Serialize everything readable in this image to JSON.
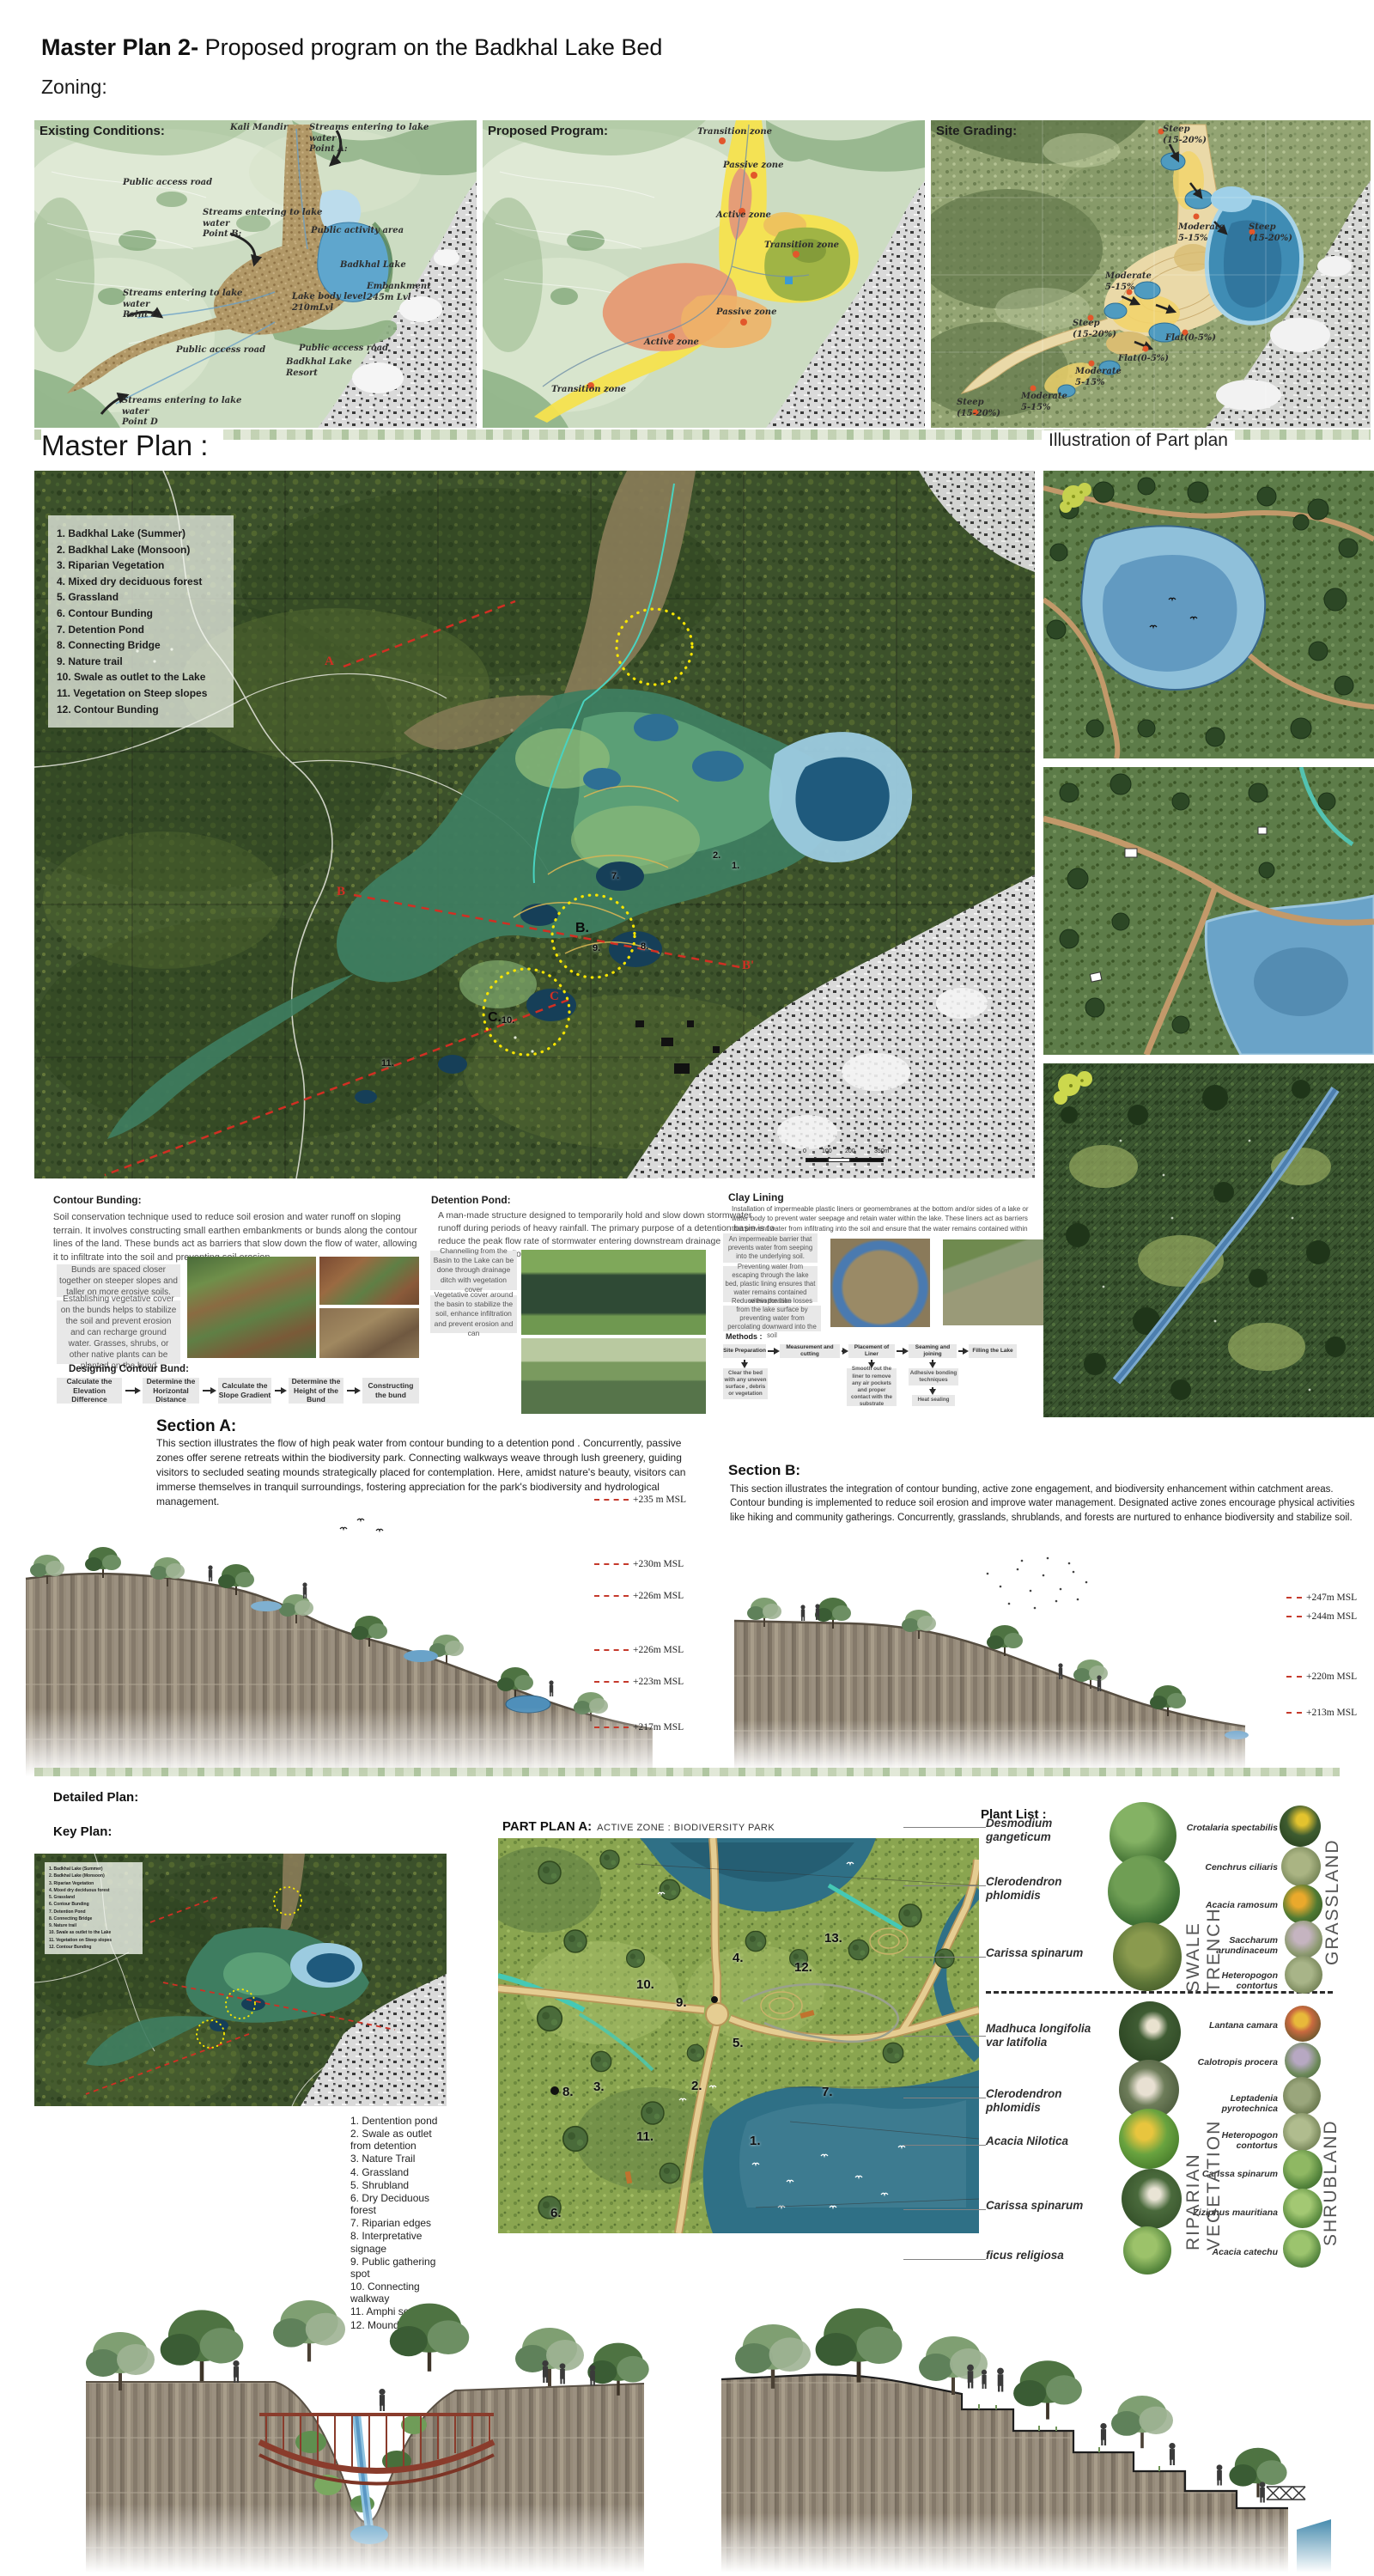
{
  "header": {
    "title_bold": "Master Plan 2-",
    "title_rest": " Proposed program on the Badkhal Lake Bed",
    "zoning_label": "Zoning:"
  },
  "zoning": {
    "existing": {
      "title": "Existing Conditions:",
      "annotations": [
        {
          "text": "Kali Mandir"
        },
        {
          "text": "Streams entering to lake\nwater\nPoint A:"
        },
        {
          "text": "Public access road"
        },
        {
          "text": "Streams entering to lake\nwater\nPoint B:"
        },
        {
          "text": "Public activity area"
        },
        {
          "text": "Badkhal Lake"
        },
        {
          "text": "Embankment\n245m Lvl"
        },
        {
          "text": "Lake body level\n210mLvl"
        },
        {
          "text": "Streams entering to lake\nwater\nPoint C:"
        },
        {
          "text": "Public access road"
        },
        {
          "text": "Badkhal Lake\nResort"
        },
        {
          "text": "Public access road"
        },
        {
          "text": "Streams entering to lake\nwater\nPoint D"
        }
      ]
    },
    "proposed": {
      "title": "Proposed Program:",
      "annotations": [
        {
          "text": "Transition zone"
        },
        {
          "text": "Passive zone"
        },
        {
          "text": "Active zone"
        },
        {
          "text": "Transition zone"
        },
        {
          "text": "Passive zone"
        },
        {
          "text": "Active zone"
        },
        {
          "text": "Transition zone"
        }
      ]
    },
    "grading": {
      "title": "Site Grading:",
      "annotations": [
        {
          "text": "Steep\n(15-20%)"
        },
        {
          "text": "Moderate\n5-15%"
        },
        {
          "text": "Steep\n(15-20%)"
        },
        {
          "text": "Moderate\n5-15%"
        },
        {
          "text": "Steep\n(15-20%)"
        },
        {
          "text": "Flat(0-5%)"
        },
        {
          "text": "Flat(0-5%)"
        },
        {
          "text": "Moderate\n5-15%"
        },
        {
          "text": "Moderate\n5-15%"
        },
        {
          "text": "Steep\n(15-20%)"
        }
      ]
    }
  },
  "master_plan": {
    "heading": "Master Plan :",
    "legend": [
      "1. Badkhal Lake (Summer)",
      "2. Badkhal Lake (Monsoon)",
      "3. Riparian Vegetation",
      "4. Mixed dry deciduous forest",
      "5. Grassland",
      "6. Contour Bunding",
      "7. Detention Pond",
      "8. Connecting Bridge",
      "9. Nature trail",
      "10. Swale as outlet to the Lake",
      "11. Vegetation on Steep slopes",
      "12. Contour Bunding"
    ],
    "section_labels": {
      "a": "A",
      "b": "B",
      "b2": "B'",
      "c": "C"
    },
    "area_labels": {
      "b": "B.",
      "c": "C."
    },
    "map_numbers": [
      "1.",
      "2.",
      "7.",
      "8.",
      "9.",
      "10.",
      "11."
    ],
    "scale_labels": [
      "0",
      "100",
      "200",
      "350m"
    ]
  },
  "illustration_heading": "Illustration of Part plan",
  "techniques": {
    "contour": {
      "title": "Contour Bunding:",
      "body": "Soil conservation technique used to reduce soil erosion and water runoff on sloping terrain. It involves constructing small earthen embankments or bunds along the contour lines of the land. These bunds act as barriers that slow down the flow of water, allowing it to infiltrate into the soil and preventing soil erosion.",
      "note1": "Bunds are spaced closer together on steeper slopes and taller on more erosive soils.",
      "note2": "Establishing vegetative cover on the bunds helps to stabilize the soil and prevent erosion and can recharge ground water. Grasses, shrubs, or other native plants can be planted on the bund",
      "flow_title": "Designing Contour Bund:",
      "steps": [
        "Calculate the Elevation Difference",
        "Determine the Horizontal Distance",
        "Calculate the Slope Gradient",
        "Determine the Height of the Bund",
        "Constructing the bund"
      ]
    },
    "detention": {
      "title": "Detention Pond:",
      "body": "A man-made structure designed to temporarily hold and slow down stormwater runoff during periods of heavy rainfall. The primary purpose of a detention basin is to reduce the peak flow rate of stormwater entering downstream drainage systems, thereby mitigating flooding and erosion risks.",
      "note1": "Channelling from the Basin to the Lake can be done through drainage ditch with vegetation cover",
      "note2": "Vegetative cover around the basin to stabilize the soil, enhance infiltration and prevent erosion and can"
    },
    "clay": {
      "title": "Clay Lining",
      "body": "Installation of impermeable plastic liners or geomembranes at the bottom and/or sides of a lake or water body to prevent water seepage and retain water within the lake. These liners act as barriers that prevent water from infiltrating into the soil and ensure that the water remains contained within the lake.",
      "note1": "An impermeable barrier that prevents water from seeping into the underlying soil.",
      "note2": "Preventing water from escaping through the lake bed, plastic lining ensures that water remains contained within the lake",
      "note3": "Reduce evaporation losses from the lake surface by preventing water from percolating downward into the soil",
      "methods_title": "Methods :",
      "steps": [
        "Site Preparation",
        "Measurement and cutting",
        "Placement of Liner",
        "Seaming and joining",
        "Filling the Lake"
      ],
      "sub1": "Clear the bed with any uneven surface , debris or vegetation",
      "sub2": "Smooth out the liner to remove any air pockets and proper contact with the substrate",
      "sub3": "Adhesive bonding techniques",
      "sub4": "Heat sealing"
    }
  },
  "sections": {
    "a": {
      "title": "Section A:",
      "body": "This section illustrates the flow of high peak water from contour bunding to a detention pond . Concurrently, passive zones offer serene retreats within the biodiversity park. Connecting walkways weave through lush greenery, guiding visitors to secluded seating mounds strategically placed for contemplation. Here, amidst nature's beauty, visitors can immerse themselves in tranquil surroundings, fostering appreciation for the park's biodiversity and hydrological management.",
      "elevations": [
        "+235 m MSL",
        "+230m MSL",
        "+226m MSL",
        "+226m MSL",
        "+223m MSL",
        "+217m MSL"
      ]
    },
    "b": {
      "title": "Section B:",
      "body": "This section illustrates the integration of contour bunding, active zone engagement, and biodiversity enhancement within catchment areas. Contour bunding is implemented to reduce soil erosion and improve water management. Designated active zones encourage physical activities like hiking and community gatherings. Concurrently, grasslands, shrublands, and forests are nurtured to enhance biodiversity and stabilize soil.",
      "elevations": [
        "+247m MSL",
        "+244m MSL",
        "+220m MSL",
        "+213m MSL"
      ]
    }
  },
  "detailed": {
    "heading": "Detailed Plan:",
    "key_plan_label": "Key Plan:",
    "part_plan_title": "PART PLAN A:",
    "part_plan_subtitle": "ACTIVE ZONE : BIODIVERSITY PARK",
    "key_items": [
      "1. Dentention pond",
      "2. Swale as outlet from detention",
      "3. Nature Trail",
      "4. Grassland",
      "5. Shrubland",
      "6. Dry Deciduous forest",
      "7. Riparian edges",
      "8. Interpretative signage",
      "9. Public gathering spot",
      "10. Connecting walkway",
      "11. Amphi seating",
      "12. Mound seating"
    ],
    "plan_numbers": [
      "1.",
      "2.",
      "3.",
      "4.",
      "5.",
      "6.",
      "7.",
      "8.",
      "9.",
      "10.",
      "11.",
      "12.",
      "13."
    ]
  },
  "plants": {
    "heading": "Plant List :",
    "left_top": [
      "Desmodium gangeticum",
      "Clerodendron phlomidis",
      "Carissa spinarum"
    ],
    "right_top": [
      "Crotalaria spectabilis",
      "Cenchrus ciliaris",
      "Acacia ramosum",
      "Saccharum arundinaceum",
      "Heteropogon contortus"
    ],
    "left_bottom": [
      "Madhuca longifolia var latifolia",
      "Clerodendron phlomidis",
      "Acacia Nilotica",
      "Carissa spinarum",
      "ficus religiosa"
    ],
    "right_bottom": [
      "Lantana camara",
      "Calotropis procera",
      "Leptadenia pyrotechnica",
      "Heteropogon contortus",
      "Carissa spinarum",
      "Ziziphus mauritiana",
      "Acacia catechu"
    ],
    "groups": [
      "SWALE TRENCH",
      "GRASSLAND",
      "RIPARIAN VEGETATION",
      "SHRUBLAND"
    ]
  },
  "colors": {
    "accent_red": "#d12f23",
    "highlight_yellow": "#f5e400",
    "water": "#4f96c0",
    "zone_yellow": "#f6e14e",
    "zone_orange": "#eeb267",
    "zone_salmon": "#e59d77",
    "zone_green": "#a0b445"
  }
}
